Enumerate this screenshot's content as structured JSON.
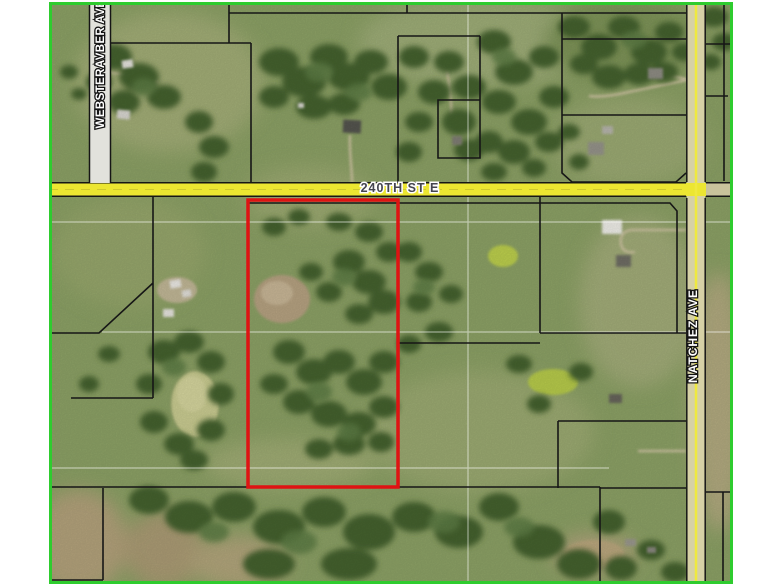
{
  "map": {
    "type": "aerial-parcel-map",
    "border_color": "#2ecc2e",
    "highlight_outline_color": "#df1313",
    "parcel_line_color": "#161616",
    "roads": {
      "r240th": {
        "label": "240TH ST E",
        "fill": "#ece631"
      },
      "webster": {
        "label": "WEBSTERAVBER AVE",
        "fill": "#e2e2dc"
      },
      "natchez": {
        "label": "NATCHEZ AVE",
        "fill": "#d6d1a6",
        "centerline": "#efe93f"
      }
    }
  }
}
